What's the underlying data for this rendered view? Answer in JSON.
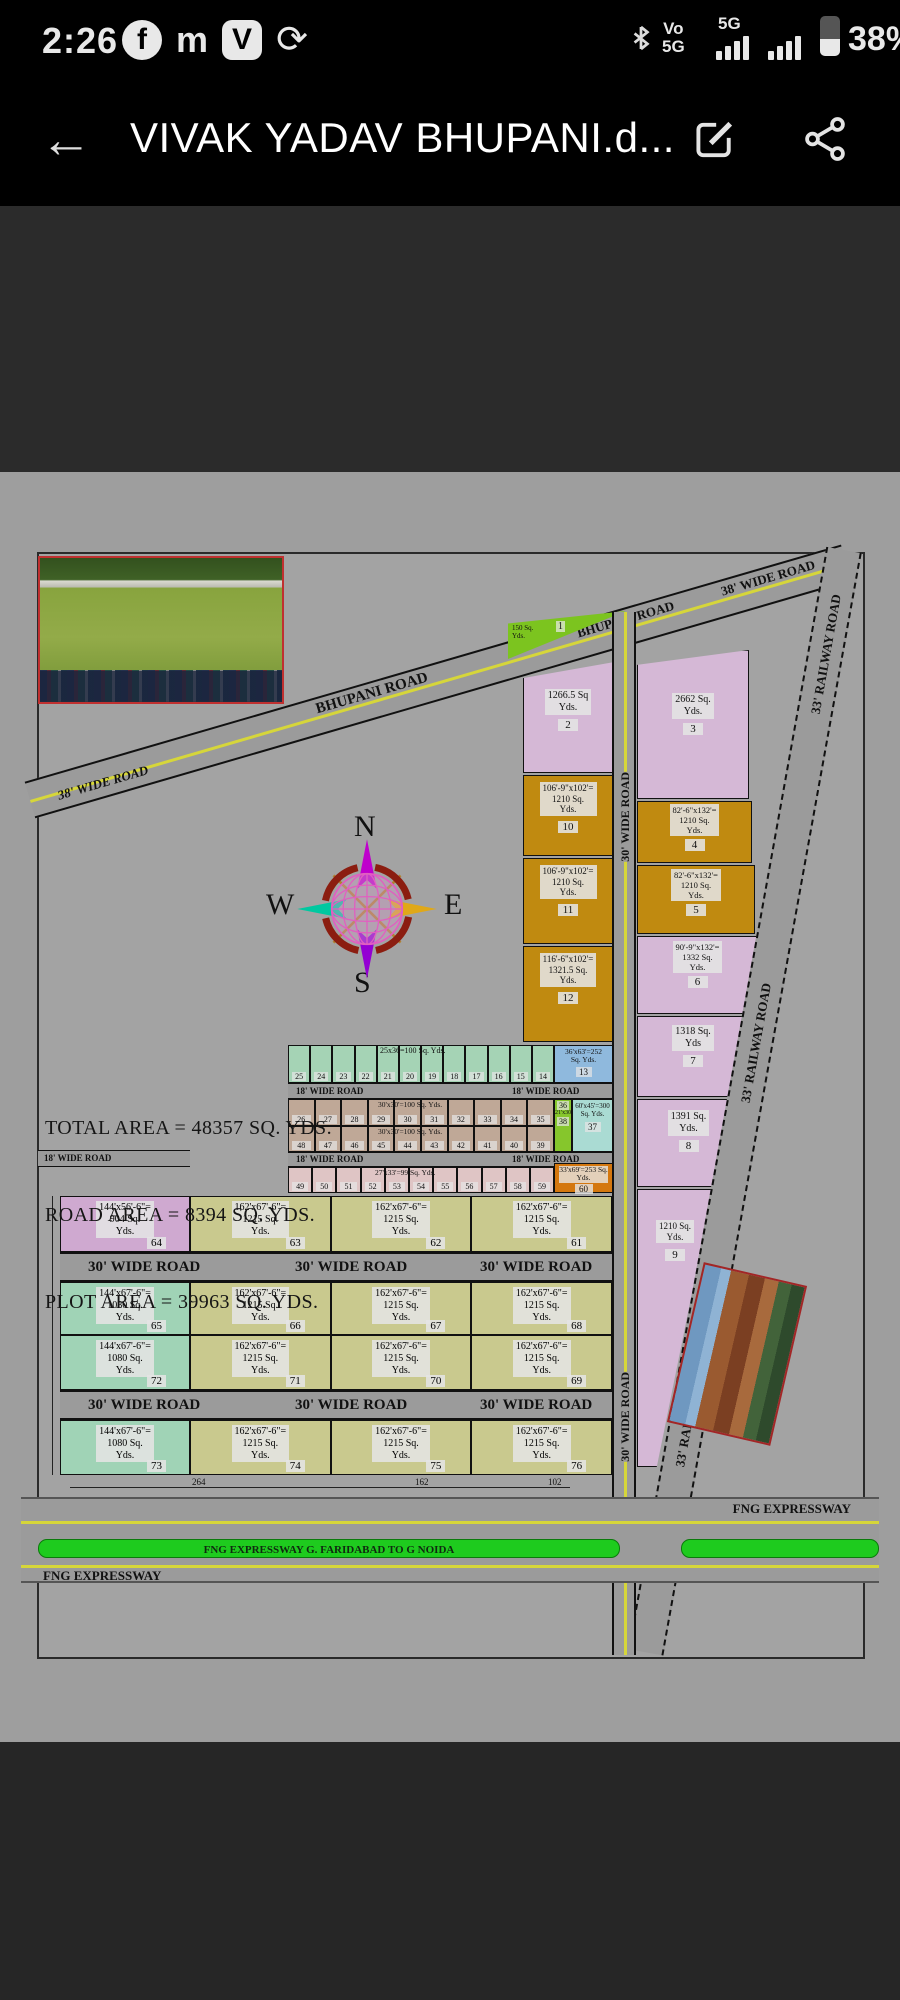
{
  "status_bar": {
    "time": "2:26",
    "notif_icons": [
      "f",
      "m",
      "V",
      "⟳"
    ],
    "vo_line1": "Vo",
    "vo_line2": "5G",
    "net": "5G",
    "battery_pct": "38%"
  },
  "app_bar": {
    "title": "VIVAK YADAV BHUPANI.d..."
  },
  "map": {
    "yds": "Yds.",
    "summary": {
      "total": "TOTAL AREA = 48357 SQ. YDS.",
      "road": "ROAD AREA = 8394 SQ. YDS.",
      "plot": "PLOT AREA = 39963 SQ. YDS."
    },
    "compass": {
      "n": "N",
      "s": "S",
      "e": "E",
      "w": "W"
    },
    "roads": {
      "wide38": "38' WIDE ROAD",
      "bhupani": "BHUPANI ROAD",
      "railway": "33' RAILWAY ROAD",
      "wide30": "30' WIDE ROAD",
      "wide18": "18' WIDE ROAD",
      "expressway": "FNG EXPRESSWAY",
      "expressway_banner": "FNG EXPRESSWAY G. FARIDABAD TO G NOIDA"
    },
    "plots": {
      "p1": {
        "num": "1",
        "l1": "150 Sq.",
        "l2": "Yds."
      },
      "p2": {
        "num": "2",
        "l1": "1266.5 Sq",
        "l2": "Yds."
      },
      "p3": {
        "num": "3",
        "l1": "2662 Sq.",
        "l2": "Yds."
      },
      "p4": {
        "num": "4",
        "l1": "82'-6\"x132'=",
        "l2": "1210 Sq.",
        "l3": "Yds."
      },
      "p5": {
        "num": "5",
        "l1": "82'-6\"x132'=",
        "l2": "1210 Sq.",
        "l3": "Yds."
      },
      "p6": {
        "num": "6",
        "l1": "90'-9\"x132'=",
        "l2": "1332 Sq.",
        "l3": "Yds."
      },
      "p7": {
        "num": "7",
        "l1": "1318 Sq.",
        "l2": "Yds"
      },
      "p8": {
        "num": "8",
        "l1": "1391 Sq.",
        "l2": "Yds."
      },
      "p9": {
        "num": "9",
        "l1": "1210 Sq.",
        "l2": "Yds."
      },
      "p10": {
        "num": "10",
        "l1": "106'-9\"x102'=",
        "l2": "1210 Sq.",
        "l3": "Yds."
      },
      "p11": {
        "num": "11",
        "l1": "106'-9\"x102'=",
        "l2": "1210 Sq.",
        "l3": "Yds."
      },
      "p12": {
        "num": "12",
        "l1": "116'-6\"x102'=",
        "l2": "1321.5 Sq.",
        "l3": "Yds."
      },
      "p13": {
        "num": "13",
        "l1": "36'x63'=252",
        "l2": "Sq. Yds."
      },
      "p37": {
        "num": "37",
        "l1": "60'x45'=300",
        "l2": "Sq. Yds."
      },
      "p60": {
        "num": "60",
        "l1": "33'x69'=253",
        "l2": "Sq. Yds."
      },
      "green_col": {
        "top": "36",
        "dims": "21'x30'=70",
        "bottom": "38"
      }
    },
    "strips": {
      "green": {
        "dims": "25x36=100 Sq. Yds.",
        "nums": [
          "25",
          "24",
          "23",
          "22",
          "21",
          "20",
          "19",
          "18",
          "17",
          "16",
          "15",
          "14"
        ]
      },
      "brown_top": {
        "dims": "30'x30'=100 Sq. Yds.",
        "nums": [
          "26",
          "27",
          "28",
          "29",
          "30",
          "31",
          "32",
          "33",
          "34",
          "35"
        ]
      },
      "brown_bottom": {
        "dims": "30'x30'=100 Sq. Yds.",
        "nums": [
          "48",
          "47",
          "46",
          "45",
          "44",
          "43",
          "42",
          "41",
          "40",
          "39"
        ]
      },
      "pink": {
        "dims": "27'x33'=99 Sq. Yds.",
        "nums": [
          "49",
          "50",
          "51",
          "52",
          "53",
          "54",
          "55",
          "56",
          "57",
          "58",
          "59"
        ]
      }
    },
    "big_plots": [
      [
        {
          "n": "64",
          "d": "144'x56'-6\"=",
          "a": "904 Sq.",
          "c": "p"
        },
        {
          "n": "63",
          "d": "162'x67'-6\"=",
          "a": "1215 Sq.",
          "c": "y"
        },
        {
          "n": "62",
          "d": "162'x67'-6\"=",
          "a": "1215 Sq.",
          "c": "y"
        },
        {
          "n": "61",
          "d": "162'x67'-6\"=",
          "a": "1215 Sq.",
          "c": "y"
        }
      ],
      [
        {
          "n": "65",
          "d": "144'x67'-6\"=",
          "a": "1080 Sq.",
          "c": "g"
        },
        {
          "n": "66",
          "d": "162'x67'-6\"=",
          "a": "1215 Sq.",
          "c": "y"
        },
        {
          "n": "67",
          "d": "162'x67'-6\"=",
          "a": "1215 Sq.",
          "c": "y"
        },
        {
          "n": "68",
          "d": "162'x67'-6\"=",
          "a": "1215 Sq.",
          "c": "y"
        }
      ],
      [
        {
          "n": "72",
          "d": "144'x67'-6\"=",
          "a": "1080 Sq.",
          "c": "g"
        },
        {
          "n": "71",
          "d": "162'x67'-6\"=",
          "a": "1215 Sq.",
          "c": "y"
        },
        {
          "n": "70",
          "d": "162'x67'-6\"=",
          "a": "1215 Sq.",
          "c": "y"
        },
        {
          "n": "69",
          "d": "162'x67'-6\"=",
          "a": "1215 Sq.",
          "c": "y"
        }
      ],
      [
        {
          "n": "73",
          "d": "144'x67'-6\"=",
          "a": "1080 Sq.",
          "c": "g"
        },
        {
          "n": "74",
          "d": "162'x67'-6\"=",
          "a": "1215 Sq.",
          "c": "y"
        },
        {
          "n": "75",
          "d": "162'x67'-6\"=",
          "a": "1215 Sq.",
          "c": "y"
        },
        {
          "n": "76",
          "d": "162'x67'-6\"=",
          "a": "1215 Sq.",
          "c": "y"
        }
      ]
    ],
    "dims": {
      "a": "264",
      "b": "162",
      "c": "102"
    }
  }
}
